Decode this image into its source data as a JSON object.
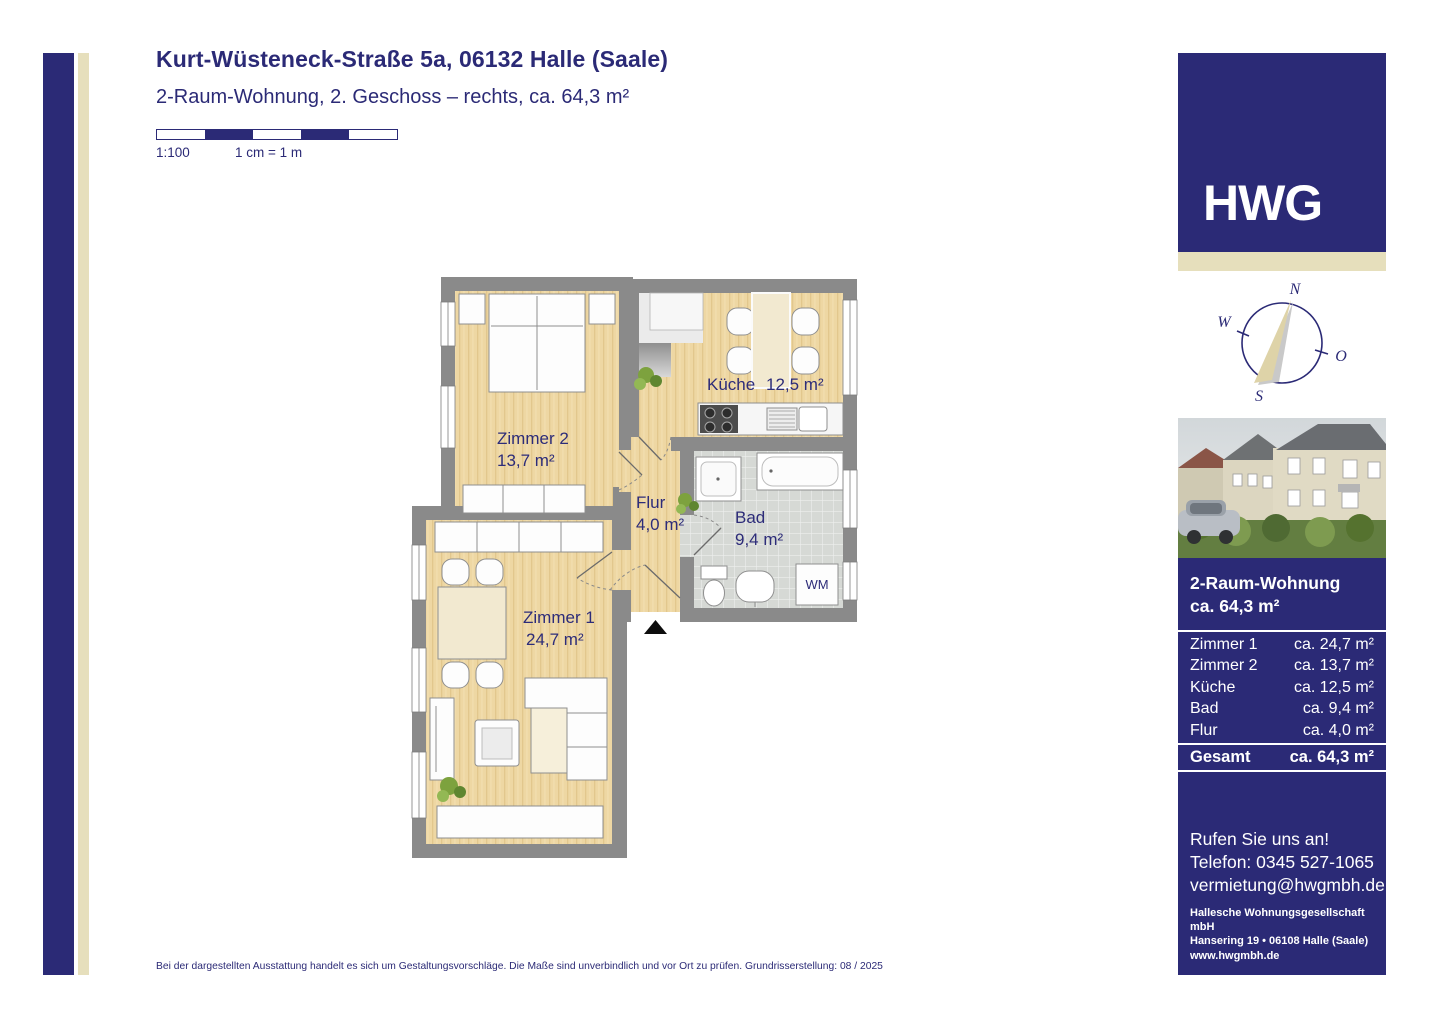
{
  "header": {
    "title": "Kurt-Wüsteneck-Straße 5a, 06132 Halle (Saale)",
    "subtitle": "2-Raum-Wohnung, 2. Geschoss – rechts, ca. 64,3 m²"
  },
  "scale": {
    "ratio": "1:100",
    "legend": "1 cm = 1 m"
  },
  "floorplan": {
    "rooms": [
      {
        "label": "Zimmer 2",
        "area": "13,7 m²"
      },
      {
        "label": "Küche",
        "area": "12,5 m²"
      },
      {
        "label": "Flur",
        "area": "4,0 m²"
      },
      {
        "label": "Bad",
        "area": "9,4 m²"
      },
      {
        "label": "Zimmer 1",
        "area": "24,7 m²"
      }
    ],
    "washing_machine": "WM"
  },
  "sidebar": {
    "logo": "HWG",
    "compass": {
      "north": "N",
      "east": "O",
      "south": "S",
      "west": "W"
    },
    "listing": {
      "line1": "2-Raum-Wohnung",
      "line2": "ca. 64,3 m²"
    },
    "area_table": {
      "rows": [
        {
          "label": "Zimmer 1",
          "value": "ca. 24,7 m²"
        },
        {
          "label": "Zimmer 2",
          "value": "ca. 13,7 m²"
        },
        {
          "label": "Küche",
          "value": "ca. 12,5 m²"
        },
        {
          "label": "Bad",
          "value": "ca. 9,4 m²"
        },
        {
          "label": "Flur",
          "value": "ca. 4,0 m²"
        }
      ],
      "total": {
        "label": "Gesamt",
        "value": "ca. 64,3 m²"
      }
    },
    "contact": {
      "cta": "Rufen Sie uns an!",
      "phone": "Telefon: 0345 527-1065",
      "email": "vermietung@hwgmbh.de",
      "company": "Hallesche Wohnungsgesellschaft mbH",
      "address": "Hansering 19 • 06108 Halle (Saale)",
      "website": "www.hwgmbh.de"
    }
  },
  "footer": {
    "note": "Bei der dargestellten Ausstattung handelt es sich um Gestaltungsvorschläge. Die Maße sind unverbindlich und vor Ort zu prüfen. Grundrisserstellung: 08 / 2025"
  },
  "colors": {
    "navy": "#2b2a76",
    "beige": "#e6dfbc",
    "wall_gray": "#8a8a8a",
    "wood": "#eed7a2",
    "tile": "#d6d9d5",
    "label": "#2d2c79"
  }
}
